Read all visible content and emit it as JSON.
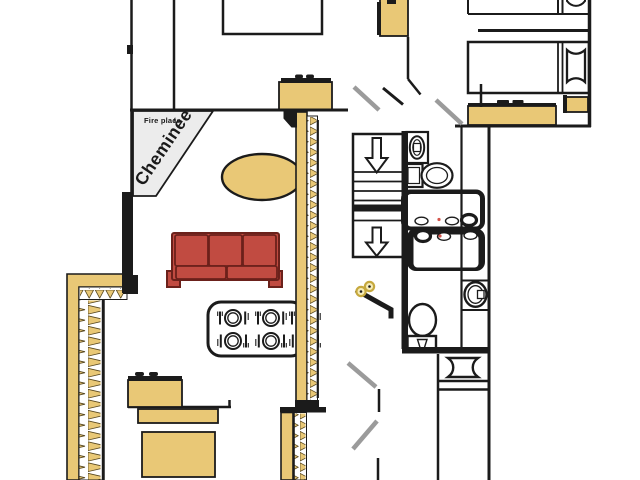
{
  "fireplace": {
    "label_en": "Fire place",
    "label_fr": "Cheminée"
  },
  "colors": {
    "wall": "#1b1b1b",
    "wood": "#e9c876",
    "sofa_red": "#c14b41",
    "sofa_outline": "#6b211b",
    "door_swing": "#9b9b9b",
    "fireplace_fill": "#ececec",
    "floor": "#ffffff",
    "flower": "#f6ecb8",
    "flower_ring": "#c6a93e",
    "accent_dot": "#d4544a"
  }
}
